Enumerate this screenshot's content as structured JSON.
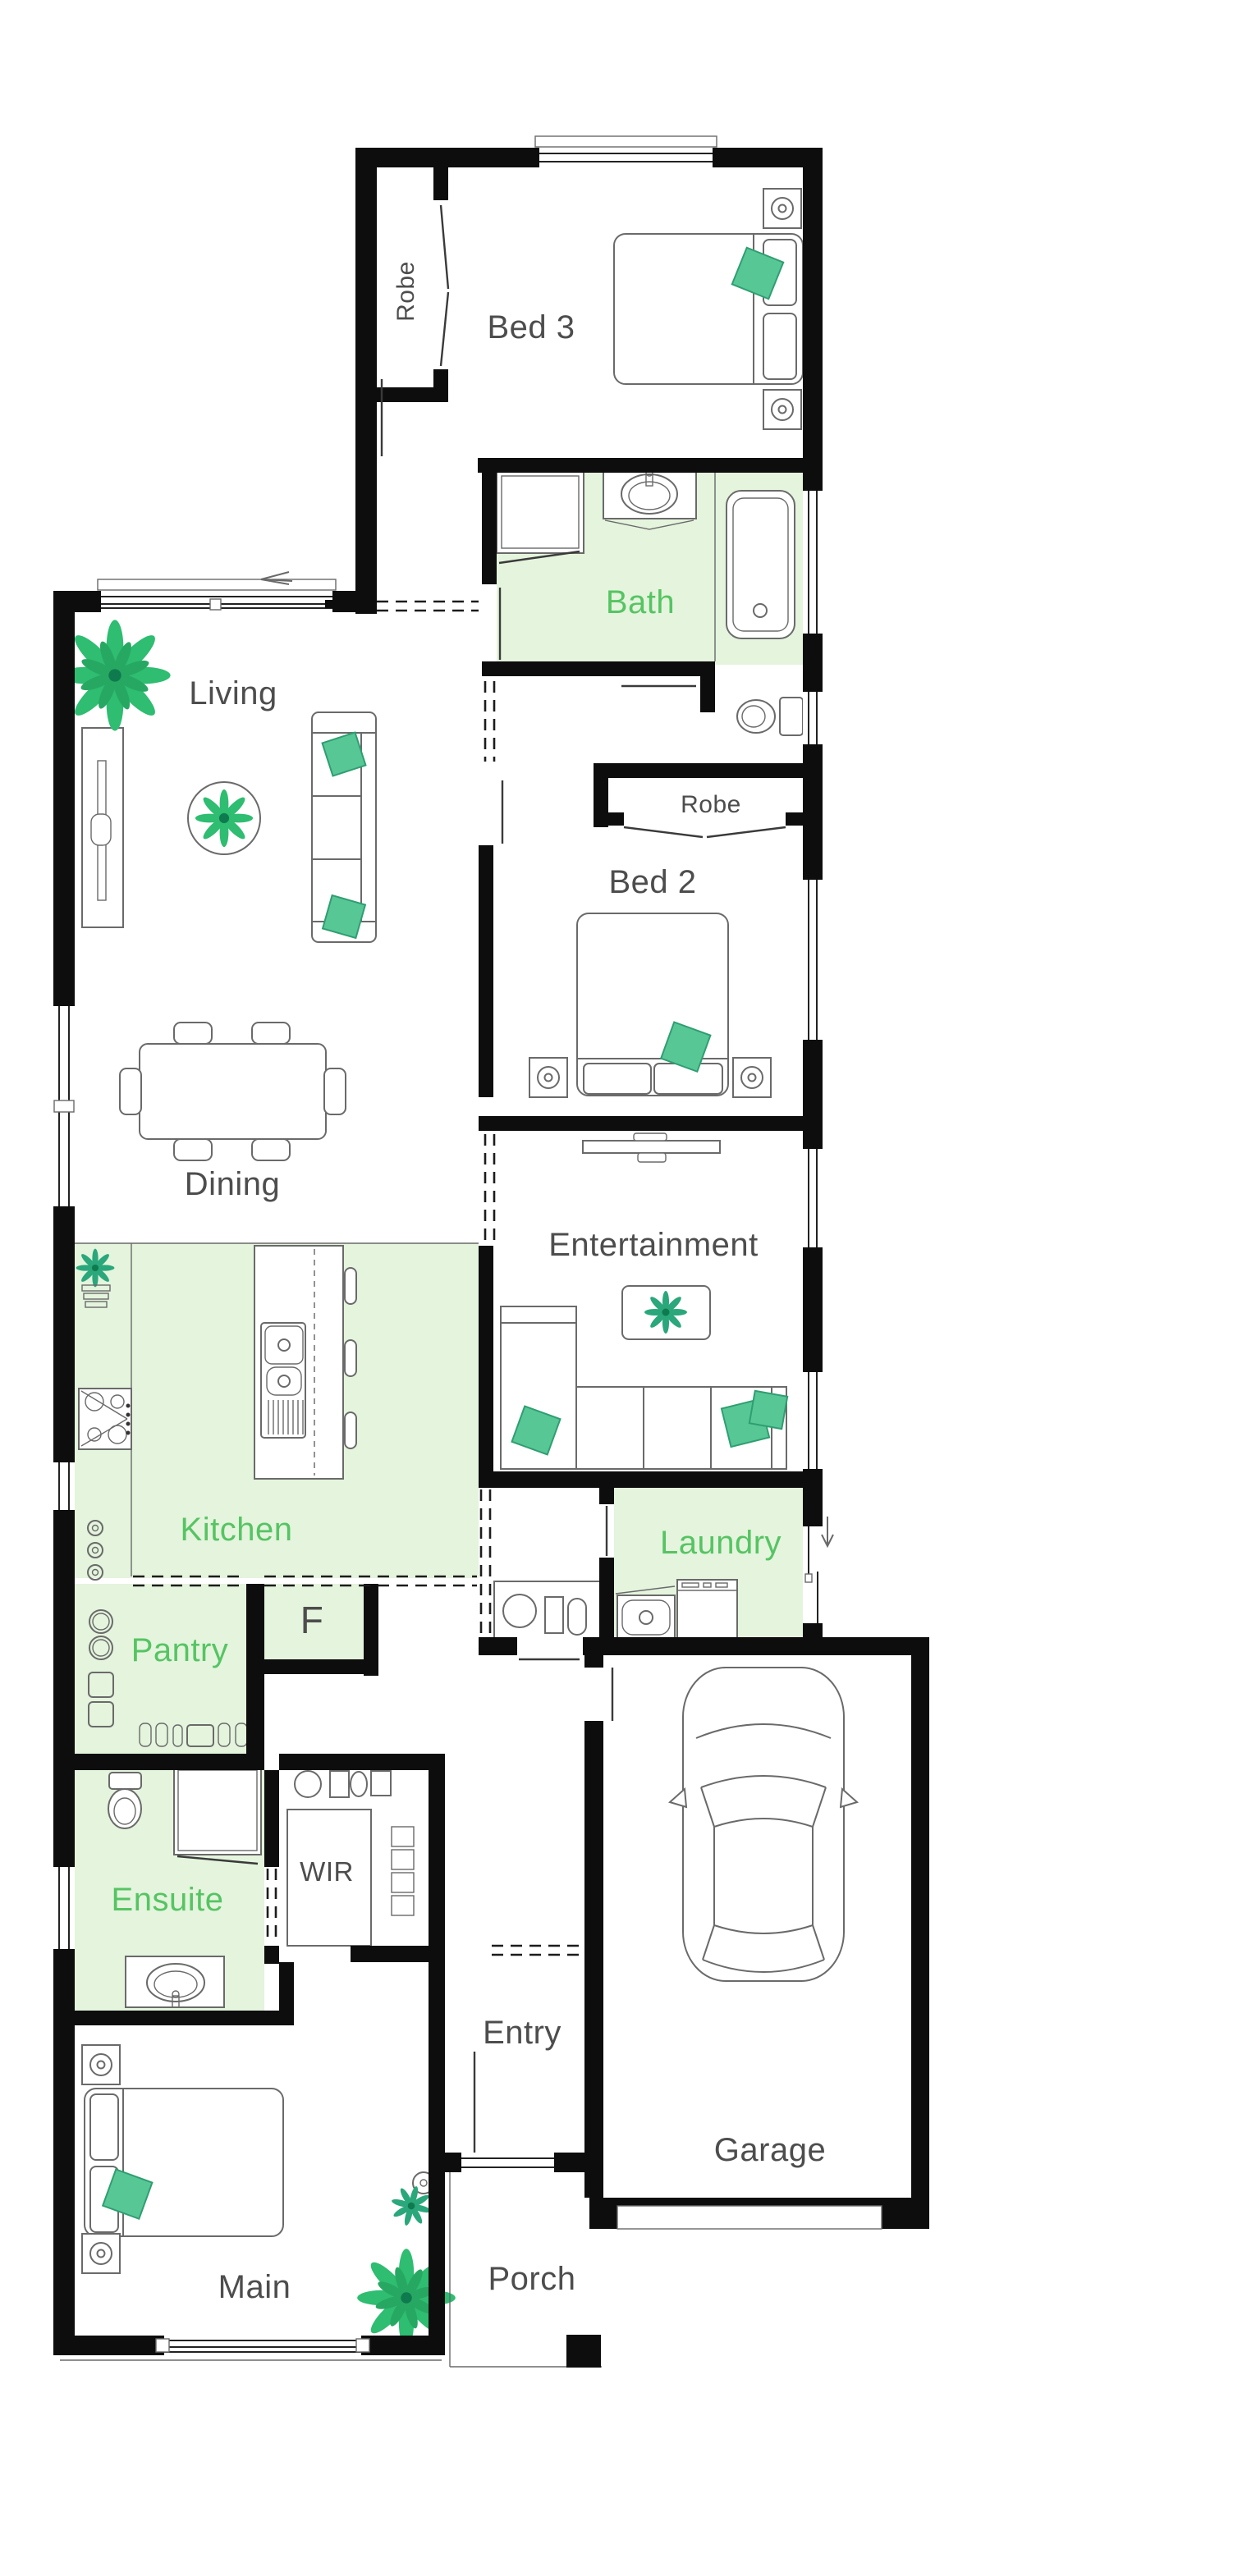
{
  "plan": {
    "labels": {
      "bed3": "Bed 3",
      "robe_bed3": "Robe",
      "bath": "Bath",
      "living": "Living",
      "robe_bed2": "Robe",
      "bed2": "Bed 2",
      "dining": "Dining",
      "entertainment": "Entertainment",
      "kitchen": "Kitchen",
      "laundry": "Laundry",
      "pantry": "Pantry",
      "fridge": "F",
      "ensuite": "Ensuite",
      "wir": "WIR",
      "entry": "Entry",
      "garage": "Garage",
      "main": "Main",
      "porch": "Porch"
    },
    "colors": {
      "wall": "#0d0d0d",
      "wet_area_fill": "#e4f4dd",
      "label_green": "#56c463",
      "label_gray": "#4d4d4d",
      "accent_teal": "#57c795",
      "accent_teal_dark": "#2f9e71",
      "plant_green": "#2ebd71",
      "plant_teal": "#2aa77b",
      "furniture_line": "#6a6a6a"
    }
  }
}
